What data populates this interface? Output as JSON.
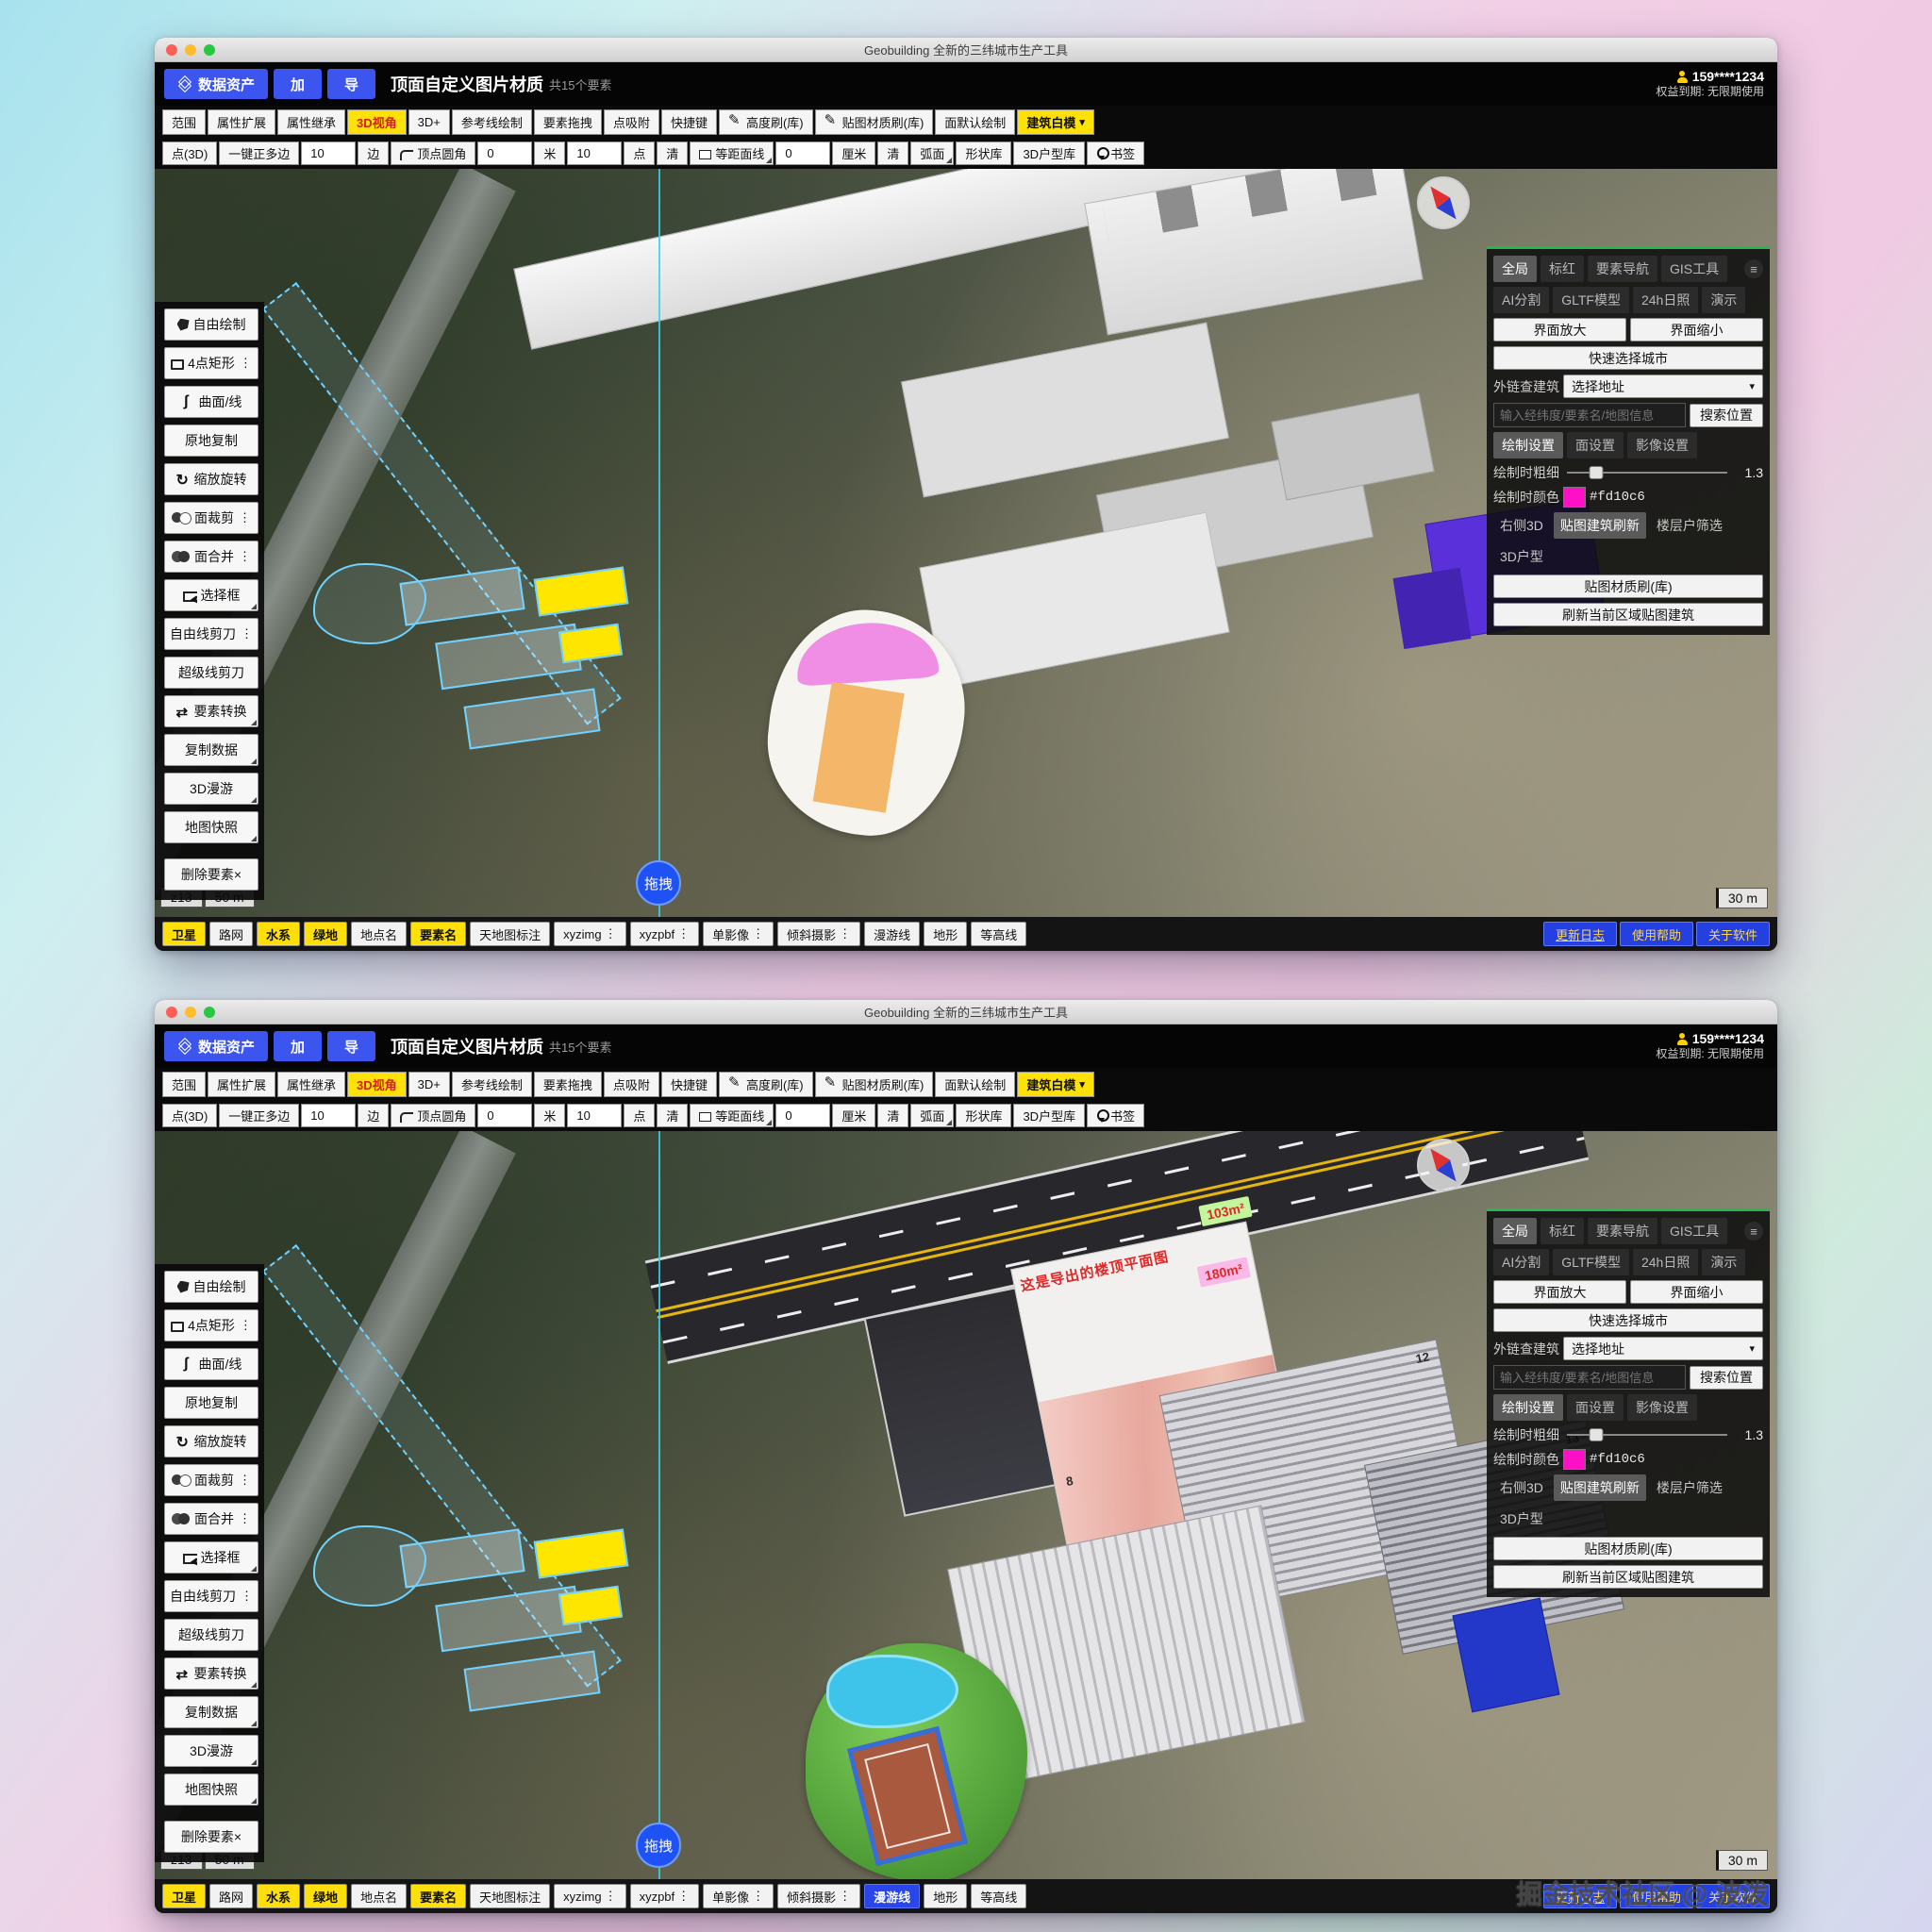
{
  "shared": {
    "titlebar": {
      "title": "Geobuilding 全新的三纬城市生产工具"
    },
    "toolbar_main": {
      "data_asset": "数据资产",
      "add": "加",
      "export": "导",
      "doc_title": "顶面自定义图片材质",
      "doc_count": "共15个要素"
    },
    "user": {
      "phone": "159****1234",
      "expiry": "权益到期: 无限期使用"
    },
    "toolbar_modes": [
      {
        "label": "范围"
      },
      {
        "label": "属性扩展"
      },
      {
        "label": "属性继承"
      },
      {
        "label": "3D视角",
        "variant": "hl-yellow-red"
      },
      {
        "label": "3D+"
      },
      {
        "label": "参考线绘制"
      },
      {
        "label": "要素拖拽"
      },
      {
        "label": "点吸附"
      },
      {
        "label": "快捷键"
      },
      {
        "label": "高度刷(库)",
        "icon": "pencil"
      },
      {
        "label": "贴图材质刷(库)",
        "icon": "pencil"
      },
      {
        "label": "面默认绘制"
      },
      {
        "label": "建筑白模",
        "variant": "hl-yellow",
        "chevron": "▾"
      }
    ],
    "toolbar_draw": [
      {
        "label": "点(3D)"
      },
      {
        "label": "一键正多边"
      },
      {
        "value": "10",
        "variant": "input"
      },
      {
        "label": "边"
      },
      {
        "label": "顶点圆角",
        "icon": "corner"
      },
      {
        "value": "0",
        "variant": "input"
      },
      {
        "label": "米"
      },
      {
        "value": "10",
        "variant": "input"
      },
      {
        "label": "点"
      },
      {
        "label": "清"
      },
      {
        "label": "等距面线",
        "icon": "square",
        "corner": true
      },
      {
        "value": "0",
        "variant": "input"
      },
      {
        "label": "厘米"
      },
      {
        "label": "清"
      },
      {
        "label": "弧面",
        "corner": true
      },
      {
        "label": "形状库"
      },
      {
        "label": "3D户型库"
      },
      {
        "label": "书签",
        "icon": "pin"
      }
    ],
    "sidebar": [
      {
        "label": "自由绘制",
        "icon": "pentagon"
      },
      {
        "label": "4点矩形",
        "icon": "rect",
        "dots": "⋮"
      },
      {
        "label": "曲面/线",
        "icon": "curve"
      },
      {
        "label": "原地复制"
      },
      {
        "label": "缩放旋转",
        "icon": "rotate"
      },
      {
        "label": "面裁剪",
        "icon": "clip",
        "dots": "⋮"
      },
      {
        "label": "面合并",
        "icon": "merge",
        "dots": "⋮"
      },
      {
        "label": "选择框",
        "icon": "select",
        "corner": true
      },
      {
        "label": "自由线剪刀",
        "dots": "⋮"
      },
      {
        "label": "超级线剪刀"
      },
      {
        "label": "要素转换",
        "icon": "swap",
        "corner": true
      },
      {
        "label": "复制数据",
        "corner": true
      },
      {
        "label": "3D漫游",
        "corner": true
      },
      {
        "label": "地图快照",
        "corner": true
      }
    ],
    "sidebar_delete": {
      "label": "删除要素×"
    },
    "right_panel": {
      "tabs_top": [
        {
          "label": "全局",
          "variant": "active"
        },
        {
          "label": "标红"
        },
        {
          "label": "要素导航"
        },
        {
          "label": "GIS工具"
        }
      ],
      "menu_icon": "≡",
      "tabs_top2": [
        {
          "label": "AI分割"
        },
        {
          "label": "GLTF模型"
        },
        {
          "label": "24h日照"
        },
        {
          "label": "演示"
        }
      ],
      "zoom_in": "界面放大",
      "zoom_out": "界面缩小",
      "quick_city": "快速选择城市",
      "link_label": "外链查建筑",
      "address_select": "选择地址",
      "address_chevron": "▾",
      "search_placeholder": "输入经纬度/要素名/地图信息",
      "search_btn": "搜索位置",
      "settings_tabs": [
        {
          "label": "绘制设置",
          "variant": "active"
        },
        {
          "label": "面设置"
        },
        {
          "label": "影像设置"
        }
      ],
      "stroke_label": "绘制时粗细",
      "stroke_value": "1.3",
      "color_label": "绘制时颜色",
      "color_hex": "#fd10c6",
      "mode_row": [
        {
          "label": "右侧3D"
        },
        {
          "label": "贴图建筑刷新",
          "variant": "active"
        },
        {
          "label": "楼层户筛选"
        }
      ],
      "unit_3d": "3D户型",
      "brush_btn": "贴图材质刷(库)",
      "refresh_btn": "刷新当前区域贴图建筑"
    },
    "bottom_links": [
      {
        "label": "更新日志",
        "variant": "underline"
      },
      {
        "label": "使用帮助"
      },
      {
        "label": "关于软件"
      }
    ],
    "map_hud": {
      "zoom_level": "z13",
      "scale_left": "50 m",
      "scale_right": "30 m",
      "drag": "拖拽"
    }
  },
  "windows": [
    {
      "scene": "white-models",
      "layers": [
        {
          "label": "卫星",
          "variant": "on"
        },
        {
          "label": "路网"
        },
        {
          "label": "水系",
          "variant": "on"
        },
        {
          "label": "绿地",
          "variant": "on"
        },
        {
          "label": "地点名"
        },
        {
          "label": "要素名",
          "variant": "on"
        },
        {
          "label": "天地图标注"
        },
        {
          "label": "xyzimg",
          "dots": "⋮"
        },
        {
          "label": "xyzpbf",
          "dots": "⋮"
        },
        {
          "label": "单影像",
          "dots": "⋮"
        },
        {
          "label": "倾斜摄影",
          "dots": "⋮"
        },
        {
          "label": "漫游线"
        },
        {
          "label": "地形"
        },
        {
          "label": "等高线"
        }
      ]
    },
    {
      "scene": "textured",
      "layers": [
        {
          "label": "卫星",
          "variant": "on"
        },
        {
          "label": "路网"
        },
        {
          "label": "水系",
          "variant": "on"
        },
        {
          "label": "绿地",
          "variant": "on"
        },
        {
          "label": "地点名"
        },
        {
          "label": "要素名",
          "variant": "on"
        },
        {
          "label": "天地图标注"
        },
        {
          "label": "xyzimg",
          "dots": "⋮"
        },
        {
          "label": "xyzpbf",
          "dots": "⋮"
        },
        {
          "label": "单影像",
          "dots": "⋮"
        },
        {
          "label": "倾斜摄影",
          "dots": "⋮"
        },
        {
          "label": "漫游线",
          "variant": "on-blue"
        },
        {
          "label": "地形"
        },
        {
          "label": "等高线"
        }
      ],
      "scene_labels": {
        "banner": "这是导出的楼顶平面图",
        "area_pink": "180m²",
        "area_green": "103m²",
        "floor_a": "8",
        "floor_b": "12",
        "floor_c": "13"
      },
      "watermark": "掘金技术社区 @ 波泼"
    }
  ]
}
